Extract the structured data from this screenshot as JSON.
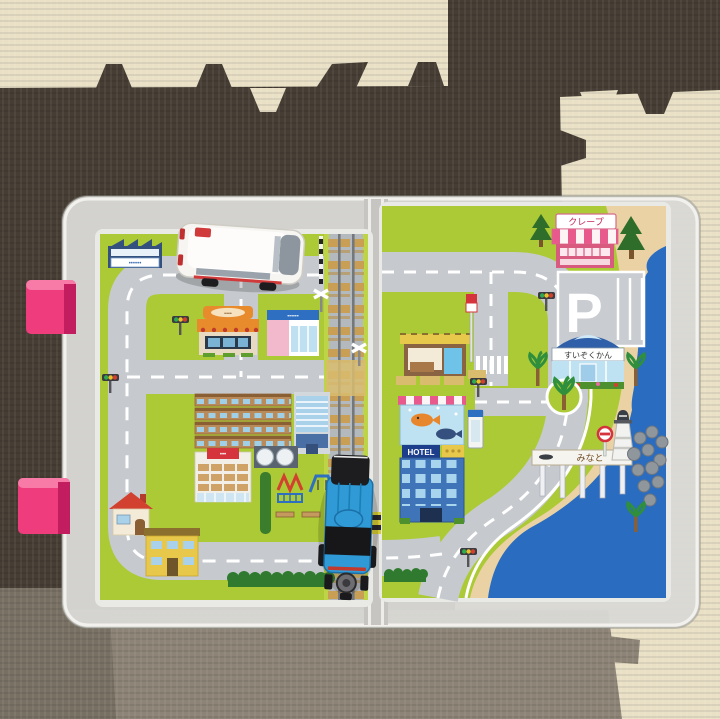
{
  "scene": {
    "description": "Photo of a printed toy town road map inside a clear plastic carry case opened flat like a book, lying on interlocking foam floor mats. A white toy ambulance van sits on the upper road of the left page and a blue toy tank engine sits on the railway track at bottom centre.",
    "floor": {
      "mat_beige": "#e9e0c6",
      "mat_dark_brown": "#463d34",
      "mat_gray": "#8d8477",
      "mat_gray_dark": "#746c5f"
    },
    "case": {
      "shell_color": "#dcdbd7",
      "hinge_color": "#c6c5c1",
      "latch_color": "#ee3c7c",
      "latch_count": "2"
    }
  },
  "left_page": {
    "factory_sign": "••••••",
    "bakery_sign": "••••",
    "market_sign": "••••••",
    "store_sign": "•••"
  },
  "right_page": {
    "crepe_sign": "クレープ",
    "parking_label": "P",
    "aquarium_sign": "すいぞくかん",
    "hotel_sign": "HOTEL",
    "harbor_sign": "みなと"
  },
  "toys": {
    "ambulance_color": "#f6f5f2",
    "ambulance_accent": "#d03a3a",
    "train_color": "#2f9ad6"
  },
  "map_colors": {
    "grass": "#abca35",
    "road": "#c6cace",
    "sea": "#2a6cc0",
    "sand": "#ead2a4",
    "rail_sleeper": "#c99f55"
  }
}
